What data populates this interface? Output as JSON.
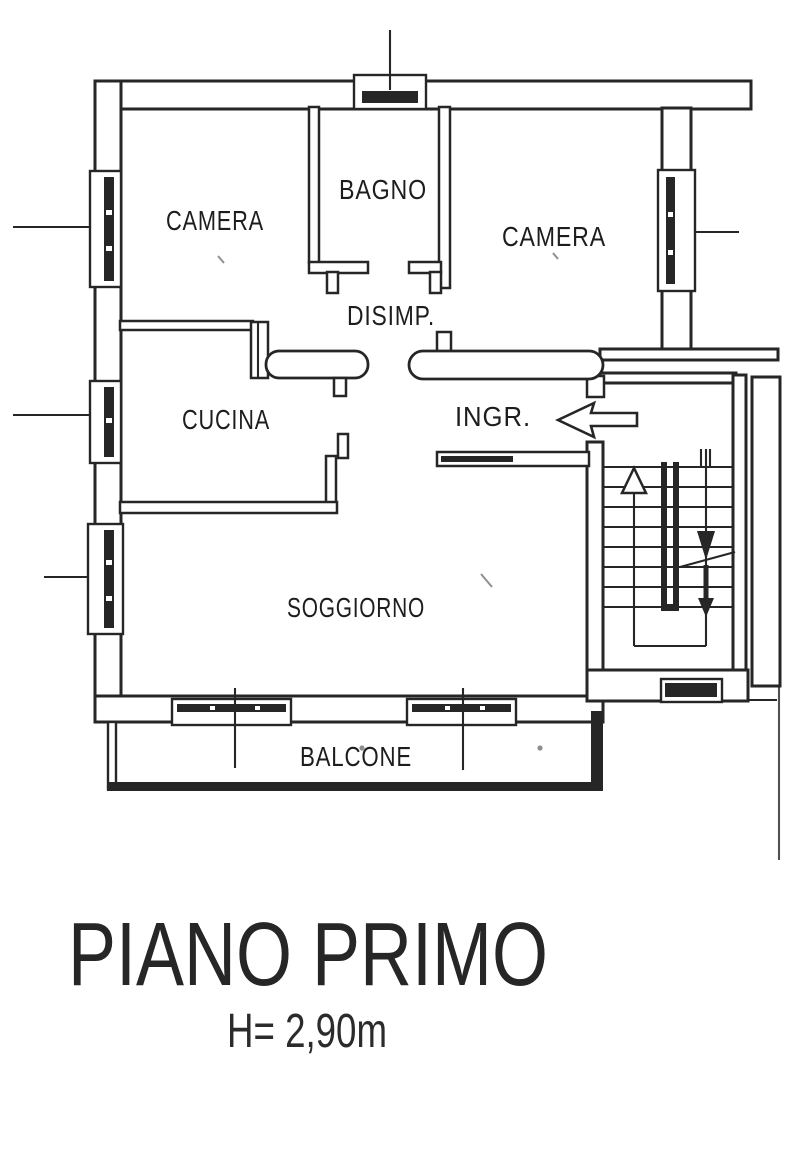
{
  "document": {
    "type": "architectural floor plan scan",
    "floor_title": "PIANO PRIMO",
    "ceiling_height": "H= 2,90m"
  },
  "rooms": [
    {
      "id": "camera-1",
      "label": "CAMERA"
    },
    {
      "id": "bagno",
      "label": "BAGNO"
    },
    {
      "id": "camera-2",
      "label": "CAMERA"
    },
    {
      "id": "disimpegno",
      "label": "DISIMP."
    },
    {
      "id": "cucina",
      "label": "CUCINA"
    },
    {
      "id": "ingresso",
      "label": "INGR."
    },
    {
      "id": "soggiorno",
      "label": "SOGGIORNO"
    },
    {
      "id": "balcone",
      "label": "BALCONE"
    }
  ],
  "symbols": {
    "entrance_arrow": "left-arrow",
    "stairs_up": "up-triangle-arrow",
    "stairs_down": "down-filled-arrow",
    "windows": "hatched-glazing-bar",
    "doors": "rounded-leaf-bar"
  },
  "colors": {
    "ink": "#262626",
    "paper": "#ffffff"
  }
}
